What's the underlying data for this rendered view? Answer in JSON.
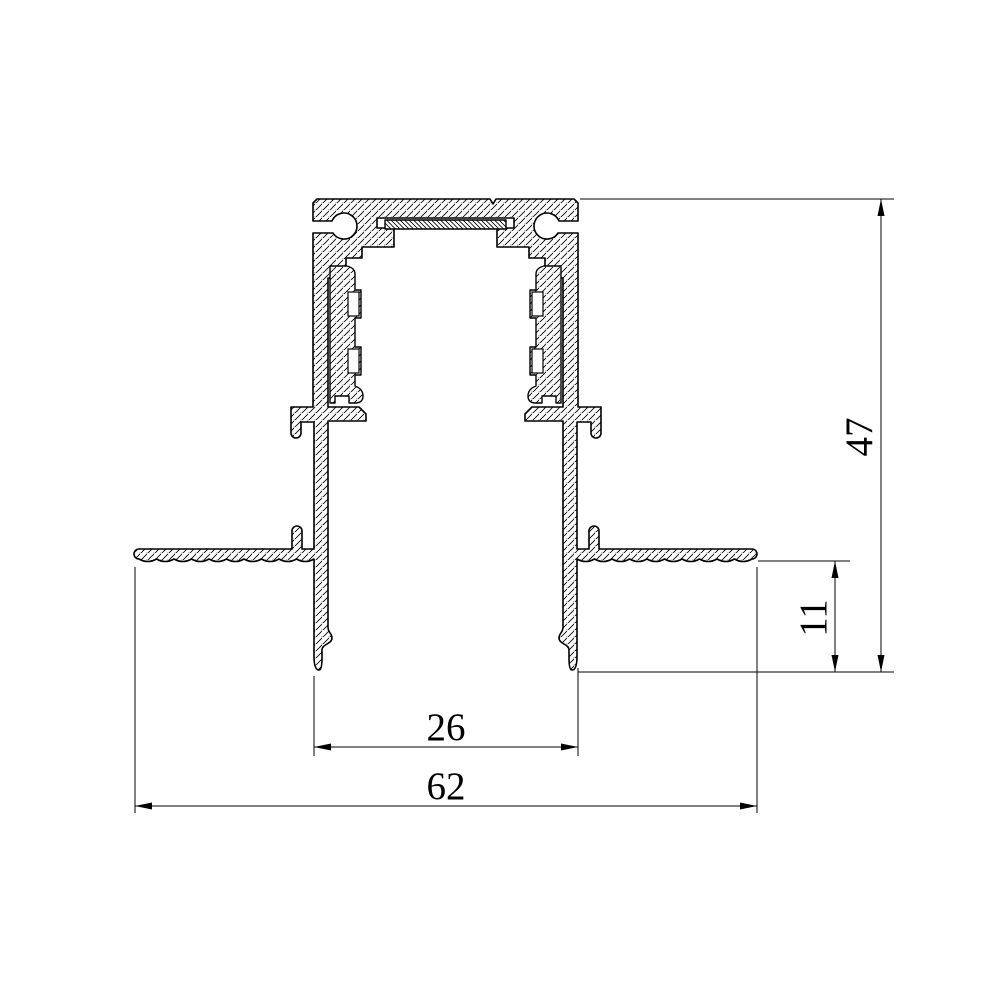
{
  "drawing": {
    "type": "technical-cross-section",
    "subject": "recessed mounting aluminum track profile",
    "colors": {
      "line": "#000000",
      "background": "#ffffff"
    },
    "dimensions": {
      "total_height": {
        "value": "47",
        "orientation": "vertical"
      },
      "recess_depth": {
        "value": "11",
        "orientation": "vertical"
      },
      "inner_width": {
        "value": "26",
        "orientation": "horizontal"
      },
      "outer_width": {
        "value": "62",
        "orientation": "horizontal"
      }
    }
  }
}
